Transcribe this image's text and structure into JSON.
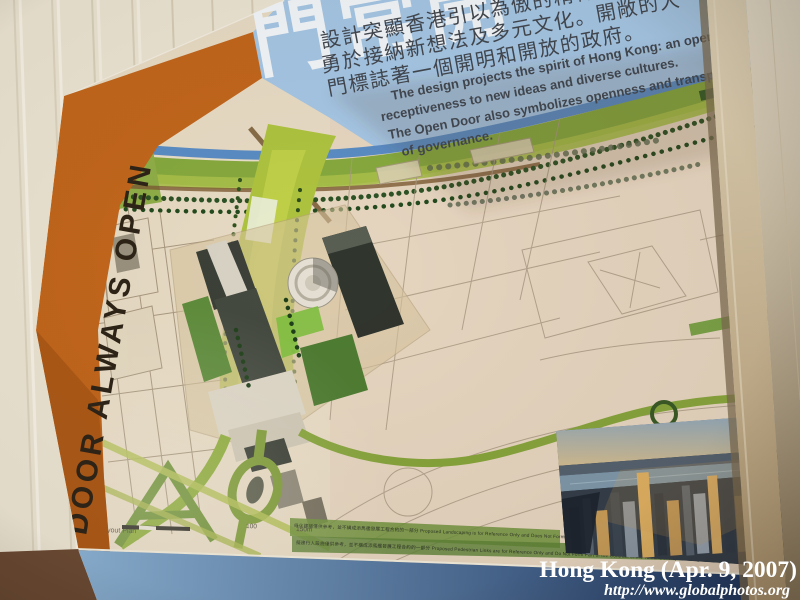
{
  "board": {
    "title_cn": "門常開",
    "intro_cn_lines": [
      "設計突顯香港引以為傲的精神．",
      "勇於接納新想法及多元文化。開敞的大",
      "門標誌著一個開明和開放的政府。"
    ],
    "intro_en_lines": [
      "The design projects the spirit of Hong Kong: an openness &",
      "receptiveness to new ideas and diverse cultures.",
      "The Open Door also symbolizes openness and transparency",
      "of governance."
    ],
    "banner_text": "DOOR ALWAYS OPEN",
    "map": {
      "plan_label": "總平面圖 Master Layout Plan",
      "scale_tick_100": "100",
      "scale_tick_150": "150m",
      "footnote_line_1": "綠化建議僅供參考，並不構成添馬艦發展工程合約的一部分  Proposed Landscaping is for Reference Only and Does Not Form Part of the Contract of the Tamar Development Project",
      "footnote_line_2": "擬建行人設施僅供參考，並不構成添馬艦發展工程合約的一部分  Proposed Pedestrian Links are for Reference Only and Do Not Form Part of the Contract of the Tamar Development Project"
    }
  },
  "watermark": {
    "caption": "Hong Kong (Apr. 9, 2007)",
    "url": "http://www.globalphotos.org"
  },
  "colors": {
    "orange": "#c2661c",
    "board_blue": "#a5c6e4",
    "paper": "#e8dbc4",
    "carpet": "#aec33f",
    "park": "#86a93e",
    "water": "#5a8cc4",
    "band_light": "#8fb6d8",
    "band_dark": "#162f5c",
    "wall": "#ece4d2",
    "banner_ink": "#2e2417",
    "title_white": "#f2f6f9",
    "intro_ink": "#42474f"
  }
}
